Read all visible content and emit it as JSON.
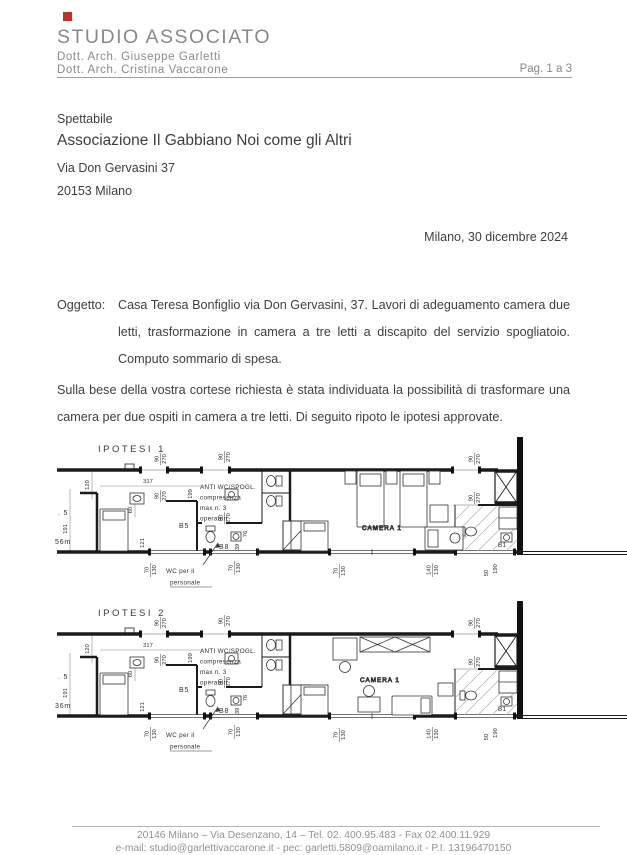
{
  "header": {
    "logo_color": "#c62f26",
    "brand": "STUDIO ASSOCIATO",
    "line1": "Dott.  Arch.  Giuseppe   Garletti",
    "line2": "Dott.  Arch.  Cristina Vaccarone",
    "page_indicator": "Pag. 1 a 3"
  },
  "recipient": {
    "salutation": "Spettabile",
    "name": "Associazione Il Gabbiano Noi come gli Altri",
    "address": "Via Don Gervasini 37",
    "city": "20153 Milano"
  },
  "dateline": "Milano, 30 dicembre 2024",
  "subject": {
    "label": "Oggetto:",
    "text": "Casa Teresa Bonfiglio via Don Gervasini, 37. Lavori di adeguamento camera due letti, trasformazione in camera a tre letti a discapito del servizio spogliatoio. Computo sommario di spesa."
  },
  "body_paragraph": "Sulla bese della vostra cortese richiesta è stata individuata la possibilità di trasformare una camera per due ospiti in camera a tre letti. Di seguito ripoto le ipotesi approvate.",
  "plans": [
    {
      "title": "IPOTESI  1",
      "labels": {
        "anti1": "ANTI  WC/SPOGL.",
        "anti2": "compresenza",
        "anti3": "max  n.  3",
        "anti4": "operatori",
        "room_b5": "B5",
        "room_b8": "B8",
        "wc1": "WC  per  il",
        "wc2": "personale",
        "camera": "CAMERA  1",
        "room_b1": "B1",
        "edge1": ". 5",
        "edge2": "56m"
      },
      "dims": {
        "v317": "317",
        "v120": "120",
        "v191": "191",
        "v60": "60",
        "v199": "199",
        "v121": "121",
        "v76": "76",
        "v39": "39",
        "door_w": "90",
        "door_h": "270",
        "win_w": "70",
        "win_h": "130",
        "win2_w": "140",
        "win2_h": "130",
        "v50": "50",
        "v190": "190"
      }
    },
    {
      "title": "IPOTESI  2",
      "labels": {
        "anti1": "ANTI  WC/SPOGL.",
        "anti2": "compresenza",
        "anti3": "max  n.  3",
        "anti4": "operatori",
        "room_b5": "B5",
        "room_b8": "B8",
        "wc1": "WC  per  il",
        "wc2": "personale",
        "camera": "CAMERA  1",
        "room_b1": "B1",
        "edge1": ". 5",
        "edge2": "36m"
      },
      "dims": {
        "v317": "317",
        "v120": "120",
        "v191": "191",
        "v60": "60",
        "v199": "199",
        "v121": "121",
        "v76": "76",
        "v39": "39",
        "door_w": "90",
        "door_h": "270",
        "win_w": "70",
        "win_h": "130",
        "win2_w": "140",
        "win2_h": "130",
        "v50": "50",
        "v190": "190"
      }
    }
  ],
  "footer": {
    "line1": "20146 Milano – Via Desenzano, 14 – Tel. 02. 400.95.483 - Fax 02.400.11.929",
    "line2": "e-mail: studio@garlettivaccarone.it - pec: garletti.5809@oamilano.it - P.I. 13196470150"
  }
}
